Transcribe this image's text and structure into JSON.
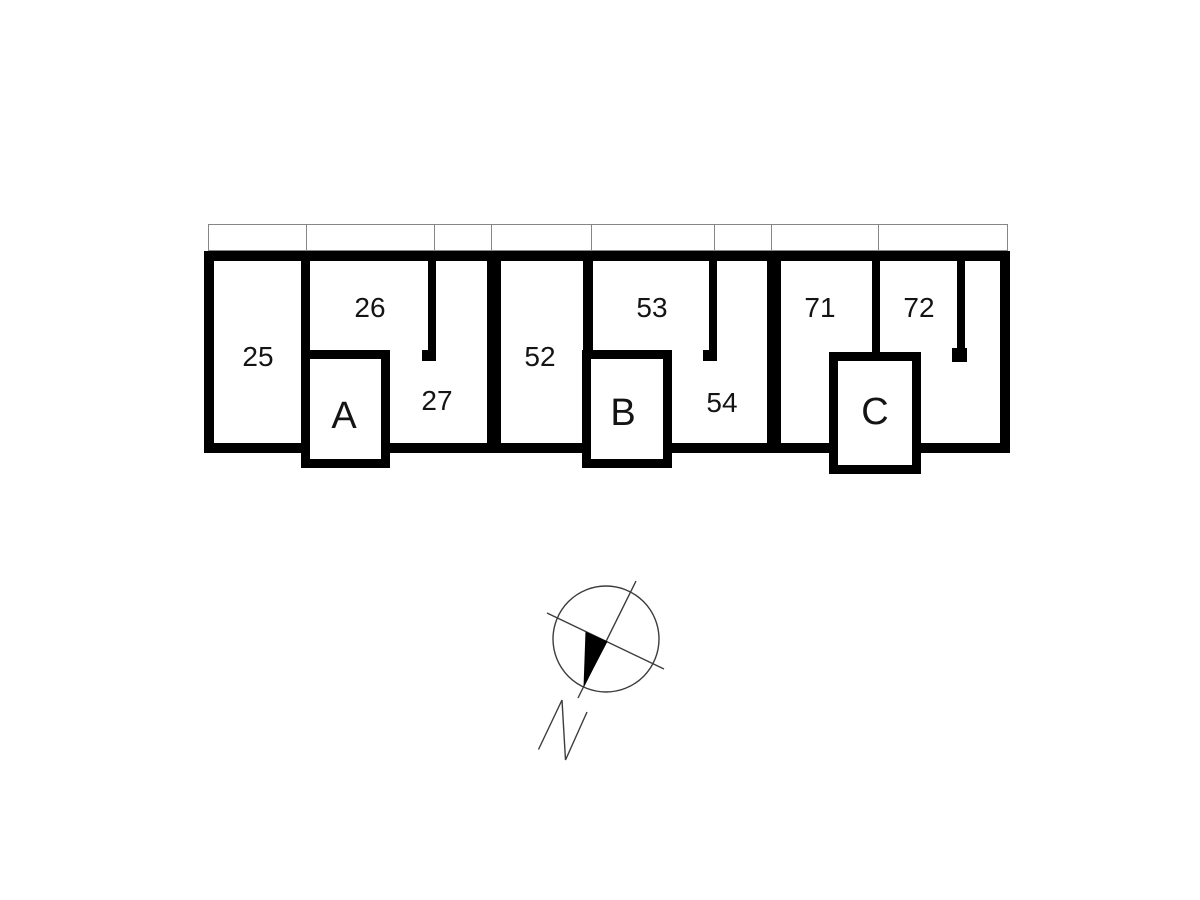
{
  "plan": {
    "title": "building-floor-plan",
    "background_color": "#ffffff",
    "wall_color": "#000000",
    "strip_line_color": "#868686",
    "rooms": [
      {
        "id": "room-25",
        "label": "25"
      },
      {
        "id": "room-26",
        "label": "26"
      },
      {
        "id": "room-27",
        "label": "27"
      },
      {
        "id": "room-52",
        "label": "52"
      },
      {
        "id": "room-53",
        "label": "53"
      },
      {
        "id": "room-54",
        "label": "54"
      },
      {
        "id": "room-71",
        "label": "71"
      },
      {
        "id": "room-72",
        "label": "72"
      }
    ],
    "stair_cores": [
      {
        "id": "core-a",
        "label": "A"
      },
      {
        "id": "core-b",
        "label": "B"
      },
      {
        "id": "core-c",
        "label": "C"
      }
    ],
    "compass": {
      "icon": "north-arrow-compass",
      "label": "N"
    }
  }
}
